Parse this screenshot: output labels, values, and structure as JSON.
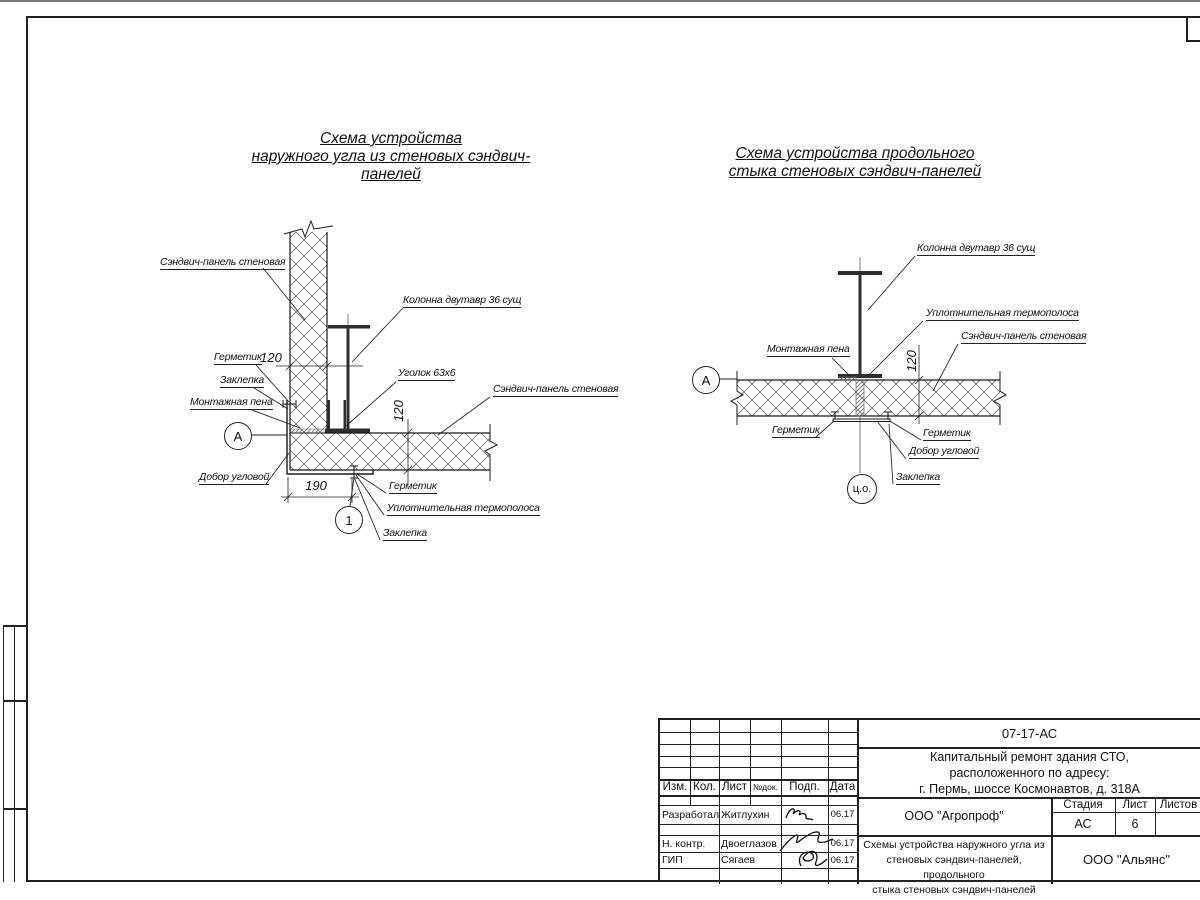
{
  "left": {
    "title1": "Схема устройства",
    "title2": "наружного угла из стеновых сэндвич-панелей",
    "panel_top": "Сэндвич-панель стеновая",
    "column": "Колонна двутавр 36 сущ",
    "sealant_top": "Герметик",
    "rivet_top": "Заклепка",
    "foam": "Монтажная пена",
    "angle": "Уголок 63х6",
    "panel_right": "Сэндвич-панель стеновая",
    "corner_trim": "Добор угловой",
    "sealant_bottom": "Герметик",
    "thermo": "Уплотнительная термополоса",
    "rivet_bottom": "Заклепка",
    "dim_panel_h": "120",
    "dim_panel_v": "120",
    "dim_bottom": "190",
    "axis_mark": "А",
    "detail_mark": "1"
  },
  "right": {
    "title1": "Схема устройства продольного",
    "title2": "стыка стеновых сэндвич-панелей",
    "column": "Колонна двутавр 36 сущ",
    "thermo": "Уплотнительная термополоса",
    "panel": "Сэндвич-панель стеновая",
    "foam": "Монтажная пена",
    "sealant_left": "Герметик",
    "sealant_right": "Герметик",
    "corner_trim": "Добор угловой",
    "rivet": "Заклепка",
    "dim_panel_v": "120",
    "axis_mark": "А",
    "center_mark": "ц.о."
  },
  "title_block": {
    "doc_number": "07-17-АС",
    "project_line1": "Капитальный ремонт здания СТО,",
    "project_line2": "расположенного по адресу:",
    "project_line3": "г. Пермь, шоссе Космонавтов, д. 318А",
    "col_izm": "Изм.",
    "col_kol": "Кол.",
    "col_list": "Лист",
    "col_doc": "№док.",
    "col_podp": "Подп.",
    "col_data": "Дата",
    "stage_label": "Стадия",
    "sheet_label": "Лист",
    "sheets_label": "Листов",
    "stage_value": "АС",
    "sheet_value": "6",
    "org": "ООО \"Агропроф\"",
    "firm": "ООО \"Альянс\"",
    "sheet_name_line1": "Схемы устройства наружного угла из",
    "sheet_name_line2": "стеновых сэндвич-панелей, продольного",
    "sheet_name_line3": "стыка стеновых сэндвич-панелей",
    "rows": [
      {
        "role": "Разработал",
        "name": "Житлухин",
        "date": "06.17"
      },
      {
        "role": "Н. контр.",
        "name": "Двоеглазов",
        "date": "06.17"
      },
      {
        "role": "ГИП",
        "name": "Сягаев",
        "date": "06.17"
      }
    ]
  }
}
